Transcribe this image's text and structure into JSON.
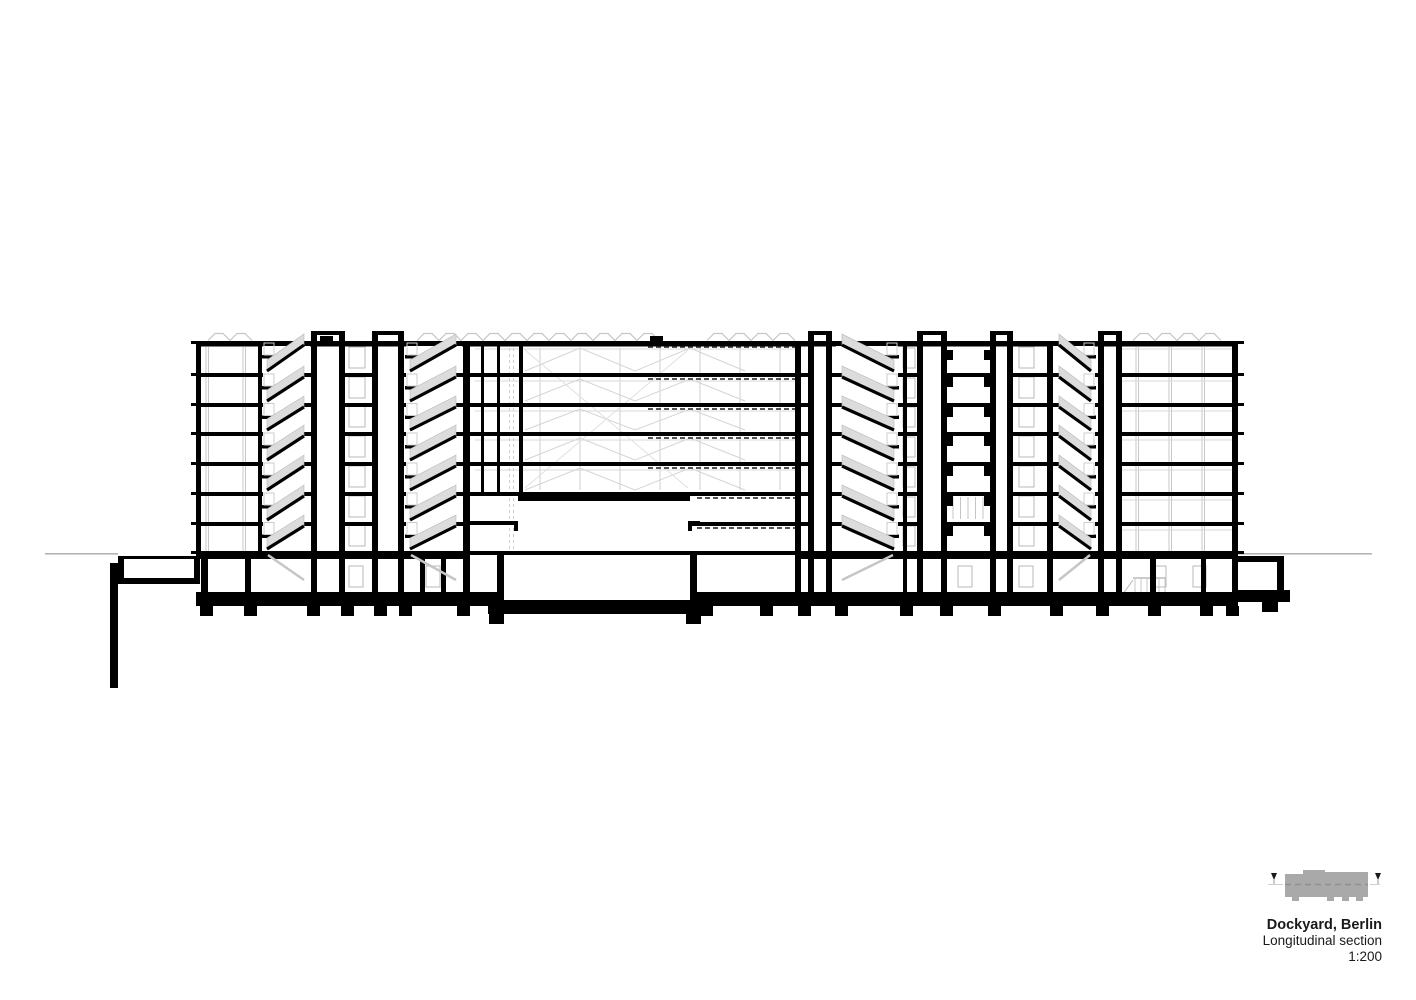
{
  "title_block": {
    "project_title": "Dockyard, Berlin",
    "drawing_title": "Longitudinal section",
    "scale": "1:200"
  },
  "drawing": {
    "type": "architectural-longitudinal-section",
    "stories_above_ground": 7,
    "stair_cores_visible": 4,
    "elevator_overruns_visible": 6,
    "has_basement_level": true,
    "central_hall_with_trusses": true
  },
  "key_plan": {
    "description": "grey site key plan footprint with dashed section line and two section-cut markers"
  },
  "colors": {
    "background": "#ffffff",
    "ink": "#000000",
    "secondary": "#c8c8c8",
    "light_rail": "#dcdcdc",
    "dashed_detail": "#3c3c3c",
    "ground_line": "#b4b4b4",
    "key_plan_fill": "#a9a9a9",
    "key_plan_dash": "#8f8f8f",
    "text": "#1a1a1a"
  }
}
